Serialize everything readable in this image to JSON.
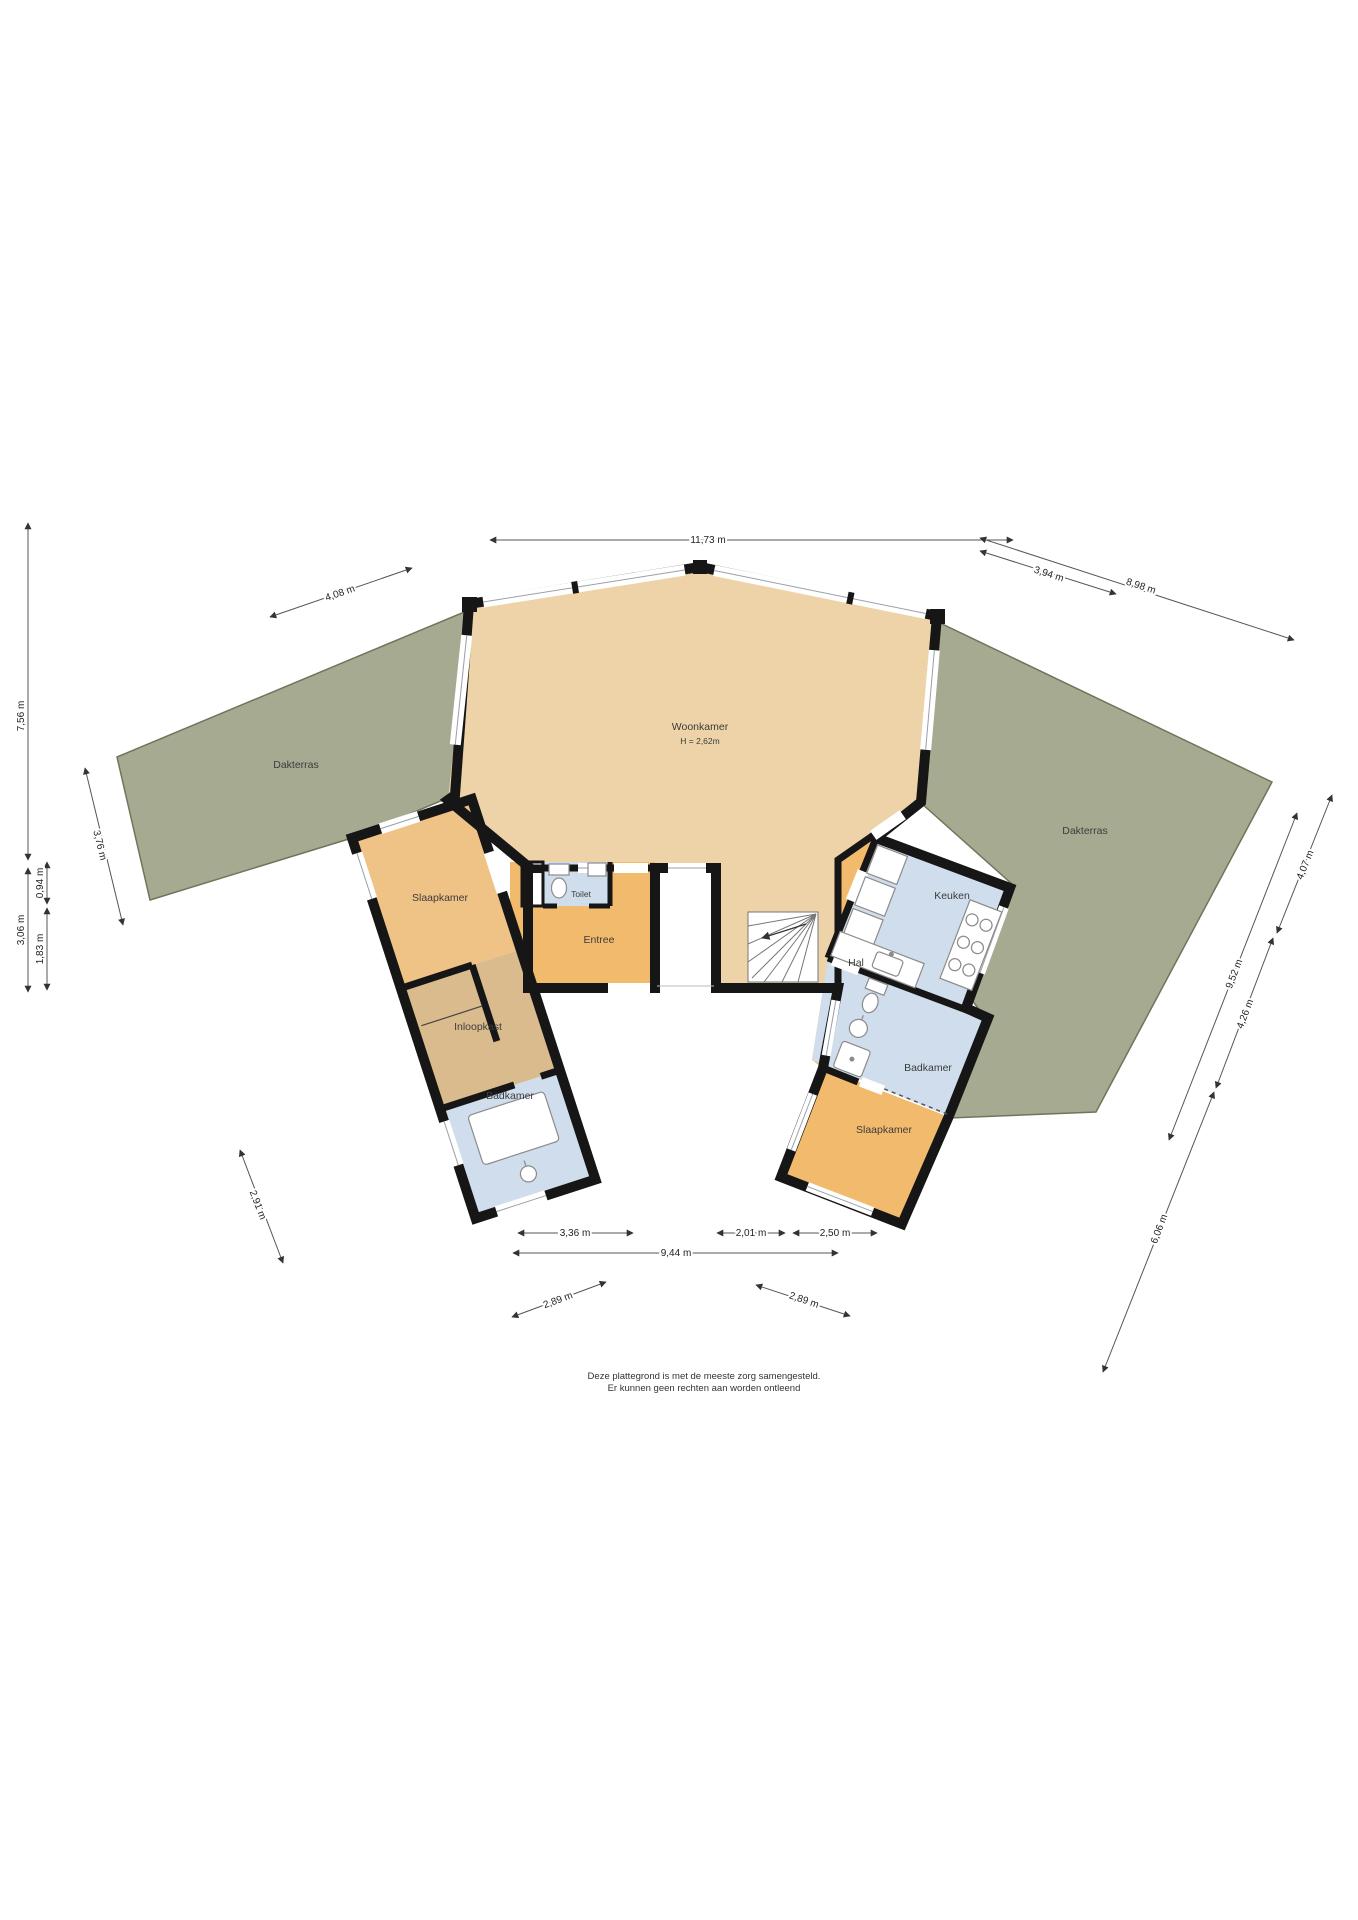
{
  "rooms": {
    "woonkamer": {
      "label": "Woonkamer",
      "height": "H = 2,62m"
    },
    "dakterras_left": {
      "label": "Dakterras"
    },
    "dakterras_right": {
      "label": "Dakterras"
    },
    "slaapkamer_left": {
      "label": "Slaapkamer"
    },
    "inloopkast": {
      "label": "Inloopkast"
    },
    "badkamer_left": {
      "label": "Badkamer"
    },
    "toilet": {
      "label": "Toilet"
    },
    "entree": {
      "label": "Entree"
    },
    "hal": {
      "label": "Hal"
    },
    "keuken": {
      "label": "Keuken"
    },
    "badkamer_right": {
      "label": "Badkamer"
    },
    "slaapkamer_right": {
      "label": "Slaapkamer"
    }
  },
  "dimensions": {
    "top_width": "11,73 m",
    "top_left": "4,08 m",
    "top_right_inner": "3,94 m",
    "top_right_outer": "8,98 m",
    "left_total": "7,56 m",
    "left_lower": "3,06 m",
    "left_inner_upper": "0,94 m",
    "left_inner_lower": "1,83 m",
    "terrace_left_edge": "3,76 m",
    "wing_left_lower": "2,91 m",
    "bottom_seg_left": "3,36 m",
    "bottom_seg_mid": "2,01 m",
    "bottom_seg_right": "2,50 m",
    "bottom_total": "9,44 m",
    "bottom_diag_left": "2,89 m",
    "bottom_diag_right": "2,89 m",
    "right_upper": "4,07 m",
    "right_total": "9,52 m",
    "right_mid": "4,26 m",
    "right_lower": "6,06 m"
  },
  "disclaimer": {
    "line1": "Deze plattegrond is met de meeste zorg samengesteld.",
    "line2": "Er kunnen geen rechten aan worden ontleend"
  },
  "colors": {
    "wall": "#161616",
    "woonkamer_floor": "#eed3a9",
    "orange_floor": "#f2ba6c",
    "slaapkamer_left_floor": "#efc285",
    "inloopkast_floor": "#d9bb8d",
    "wet_room_floor": "#cfddec",
    "terrace": "#a6aa90",
    "terrace_edge": "#70745b"
  }
}
